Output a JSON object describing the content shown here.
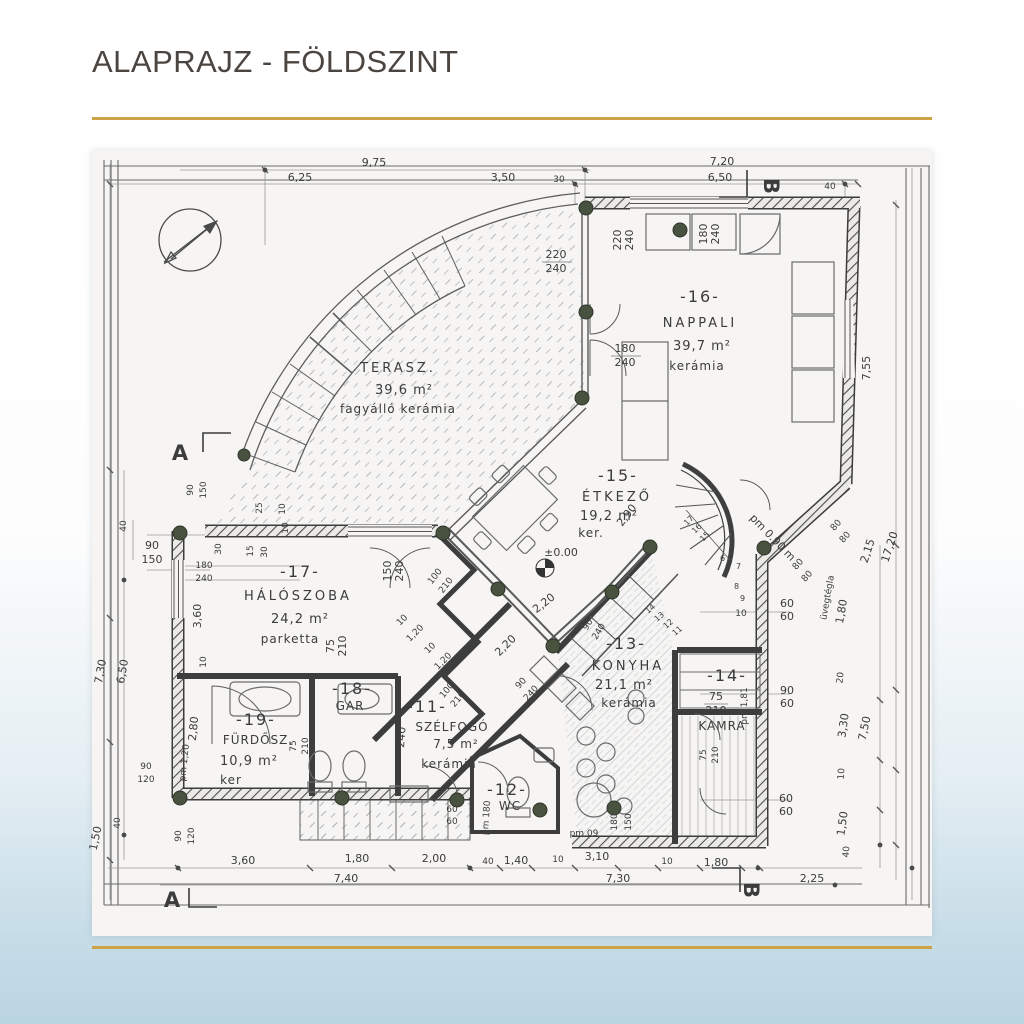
{
  "page": {
    "title": "ALAPRAJZ - FÖLDSZINT"
  },
  "icons": {
    "north_arrow": "north-arrow-icon"
  },
  "markers": {
    "a": "A",
    "b": "B"
  },
  "rooms": {
    "terasz": {
      "name": "TERASZ.",
      "area": "39,6 m²",
      "floor": "fagyálló kerámia"
    },
    "nappali": {
      "number": "-16-",
      "name": "NAPPALI",
      "area": "39,7 m²",
      "floor": "kerámia"
    },
    "etkezo": {
      "number": "-15-",
      "name": "ÉTKEZŐ",
      "area": "19,2 m²",
      "floor": "ker.",
      "dim": "2,90"
    },
    "haloszoba": {
      "number": "-17-",
      "name": "HÁLÓSZOBA",
      "area": "24,2 m²",
      "floor": "parketta"
    },
    "gar": {
      "number": "-18-",
      "name": "GAR"
    },
    "furdoszoba": {
      "number": "-19-",
      "name": "FÜRDŐSZ.",
      "area": "10,9 m²",
      "floor": "ker"
    },
    "szelfogo": {
      "number": "-11-",
      "name": "SZÉLFOGÓ",
      "area": "7,5 m²",
      "floor": "kerámia"
    },
    "wc": {
      "number": "-12-",
      "name": "WC"
    },
    "konyha": {
      "number": "-13-",
      "name": "KONYHA",
      "area": "21,1 m²",
      "floor": "kerámia"
    },
    "kamra": {
      "number": "-14-",
      "name": "KAMRA"
    }
  },
  "dims": {
    "top": [
      "9,75",
      "6,25",
      "3,50",
      "30",
      "7,20",
      "6,50",
      "40"
    ],
    "right": [
      "7,55",
      "17,20",
      "2,15",
      "80",
      "80",
      "80",
      "80",
      "1,80",
      "20",
      "90",
      "60",
      "3,30",
      "7,50",
      "10",
      "60",
      "60",
      "1,50",
      "40"
    ],
    "bottom": [
      "3,60",
      "1,80",
      "7,40",
      "2,00",
      "40",
      "1,40",
      "10",
      "3,10",
      "7,30",
      "10",
      "1,80",
      "2,25"
    ],
    "left": [
      "90",
      "150",
      "40",
      "90",
      "150",
      "30",
      "25",
      "10",
      "15",
      "30",
      "10",
      "3,60",
      "10",
      "7,30",
      "6,50",
      "2,80",
      "90",
      "120",
      "40",
      "1,50",
      "90",
      "120"
    ]
  },
  "win": {
    "etkezo_top": [
      "220",
      "240"
    ],
    "etkezo_top_rot": [
      "220",
      "240"
    ],
    "nappali_top": [
      "180",
      "240"
    ],
    "nappali_door": [
      "180",
      "240"
    ],
    "halo_left": [
      "180",
      "240"
    ],
    "halo_window": [
      "150",
      "240"
    ],
    "halo_door": [
      "75",
      "210"
    ],
    "etkezo_door": [
      "100",
      "210"
    ],
    "szelfogo_door": [
      "100",
      "210"
    ],
    "szelfogo_height": "240",
    "konyha_door": [
      "90",
      "240"
    ],
    "konyha_win": [
      "90",
      "240"
    ],
    "kamra_door": [
      "75",
      "210"
    ],
    "kamra_door2": [
      "75",
      "210"
    ],
    "furdo_door": [
      "75",
      "210"
    ],
    "wc_dims": [
      "180",
      "150"
    ],
    "porch": [
      "60",
      "60"
    ],
    "konyha_right": [
      "60",
      "60"
    ],
    "konyha_top10": "10"
  },
  "diag": {
    "d1": "2,20",
    "d2": "2,20",
    "s1": "10",
    "s2": "1,20",
    "s3": "10",
    "s4": "1,20"
  },
  "levels": {
    "zero": "±0.00",
    "pm090": "pm 0.90 m",
    "pm180": "pm 180",
    "pm09": "pm 09",
    "pm120": "pm 1,20",
    "pm181": "pm 1,81"
  },
  "notes": {
    "uvegtegla": "üvegtégla"
  },
  "stairs": {
    "upper": [
      "17",
      "16",
      "15",
      "6",
      "7",
      "8",
      "9"
    ],
    "lower": [
      "14",
      "13",
      "12",
      "11"
    ]
  }
}
